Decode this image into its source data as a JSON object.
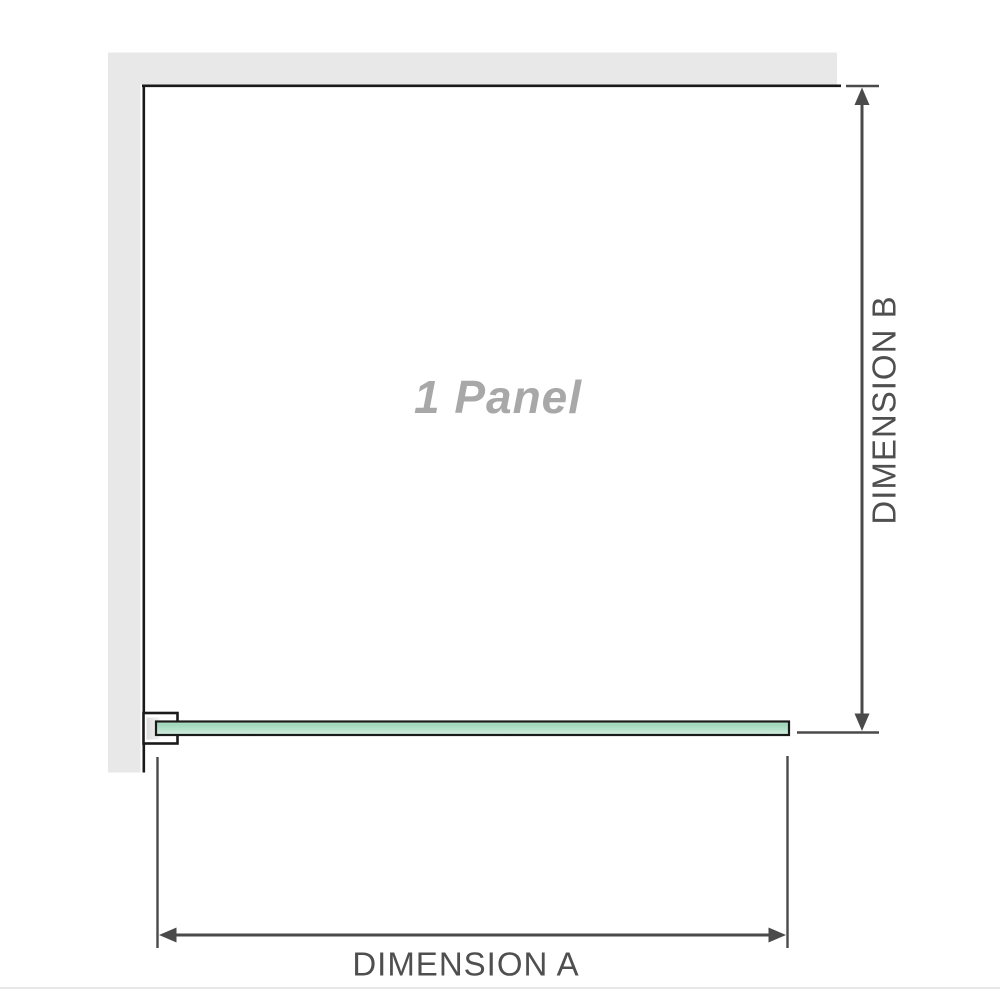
{
  "diagram": {
    "panel_label": "1 Panel",
    "dimensions": {
      "width_label": "DIMENSION A",
      "height_label": "DIMENSION B"
    }
  },
  "colors": {
    "page_bg": "#ffffff",
    "wall_gray": "#e8e8e8",
    "outline_black": "#1a1a1a",
    "dimension_line_gray": "#4a4a4a",
    "dimension_label_gray": "#4f4f4f",
    "panel_label_gray": "#a8a8a8",
    "glass_green_dark": "#9dd6b8",
    "glass_green_light": "#ddf2e8",
    "glass_green_mid": "#b3e0c9",
    "glass_green_pale": "#cdeadb",
    "bracket_fill": "#ffffff",
    "bracket_inner_gray": "#dcdcdc",
    "divider_gray": "#e0e0e0"
  }
}
